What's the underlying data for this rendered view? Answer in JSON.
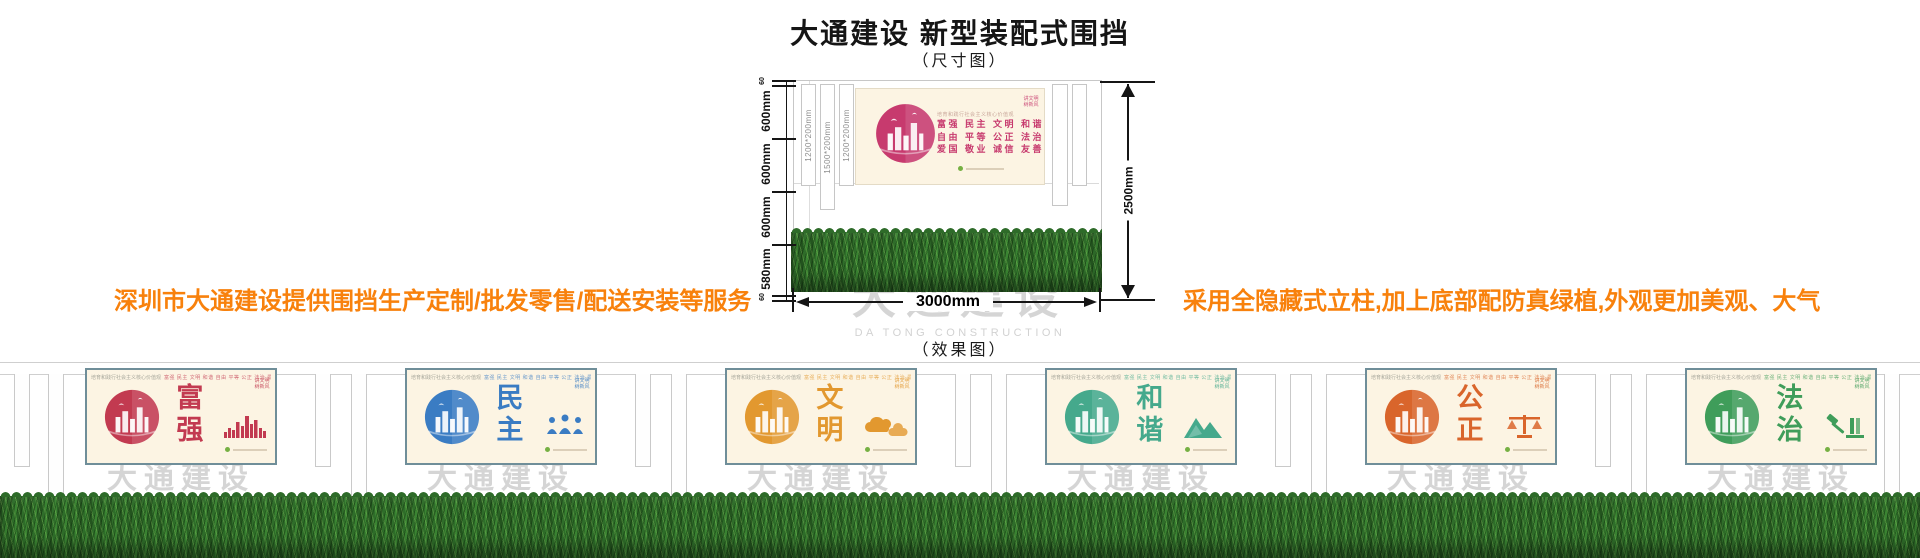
{
  "header": {
    "title": "大通建设 新型装配式围挡",
    "size_caption": "（尺寸图）",
    "effect_caption": "（效果图）"
  },
  "notes": {
    "color": "#f8810c",
    "left": "深圳市大通建设提供围挡生产定制/批发零售/配送安装等服务",
    "right": "采用全隐藏式立柱,加上底部配防真绿植,外观更加美观、大气"
  },
  "diagram": {
    "total_height": "2500mm",
    "total_width": "3000mm",
    "left_dims": [
      "60",
      "600mm",
      "600mm",
      "600mm",
      "580mm",
      "60"
    ],
    "post_labels": [
      "1200*200mm",
      "1500*200mm",
      "1200*200mm"
    ],
    "board": {
      "accent": "#c73a6e",
      "header_line": "培育和践行社会主义核心价值观",
      "slogan_line1": "富强 民主 文明 和谐",
      "slogan_line2": "自由 平等 公正 法治",
      "slogan_line3": "爱国 敬业 诚信 友善",
      "corner_badge": "讲文明 树新风"
    },
    "watermark_cn": "大通建设",
    "watermark_en": "DA TONG CONSTRUCTION"
  },
  "effect": {
    "watermark_cn": "大通建设",
    "watermark_en": "DA TONG CONSTRUCTION",
    "header_intro": "培育和践行社会主义核心价值观",
    "header_values": "富强 民主 文明 和谐 自由 平等 公正 法治 爱国 敬业 诚信 友善",
    "corner_badge": "讲文明 树新风",
    "panels": [
      {
        "word": "富强",
        "color": "#c23a50"
      },
      {
        "word": "民主",
        "color": "#3a7cc3"
      },
      {
        "word": "文明",
        "color": "#e2982f"
      },
      {
        "word": "和谐",
        "color": "#45a98c"
      },
      {
        "word": "公正",
        "color": "#d9652b"
      },
      {
        "word": "法治",
        "color": "#3f9d5a"
      }
    ]
  }
}
